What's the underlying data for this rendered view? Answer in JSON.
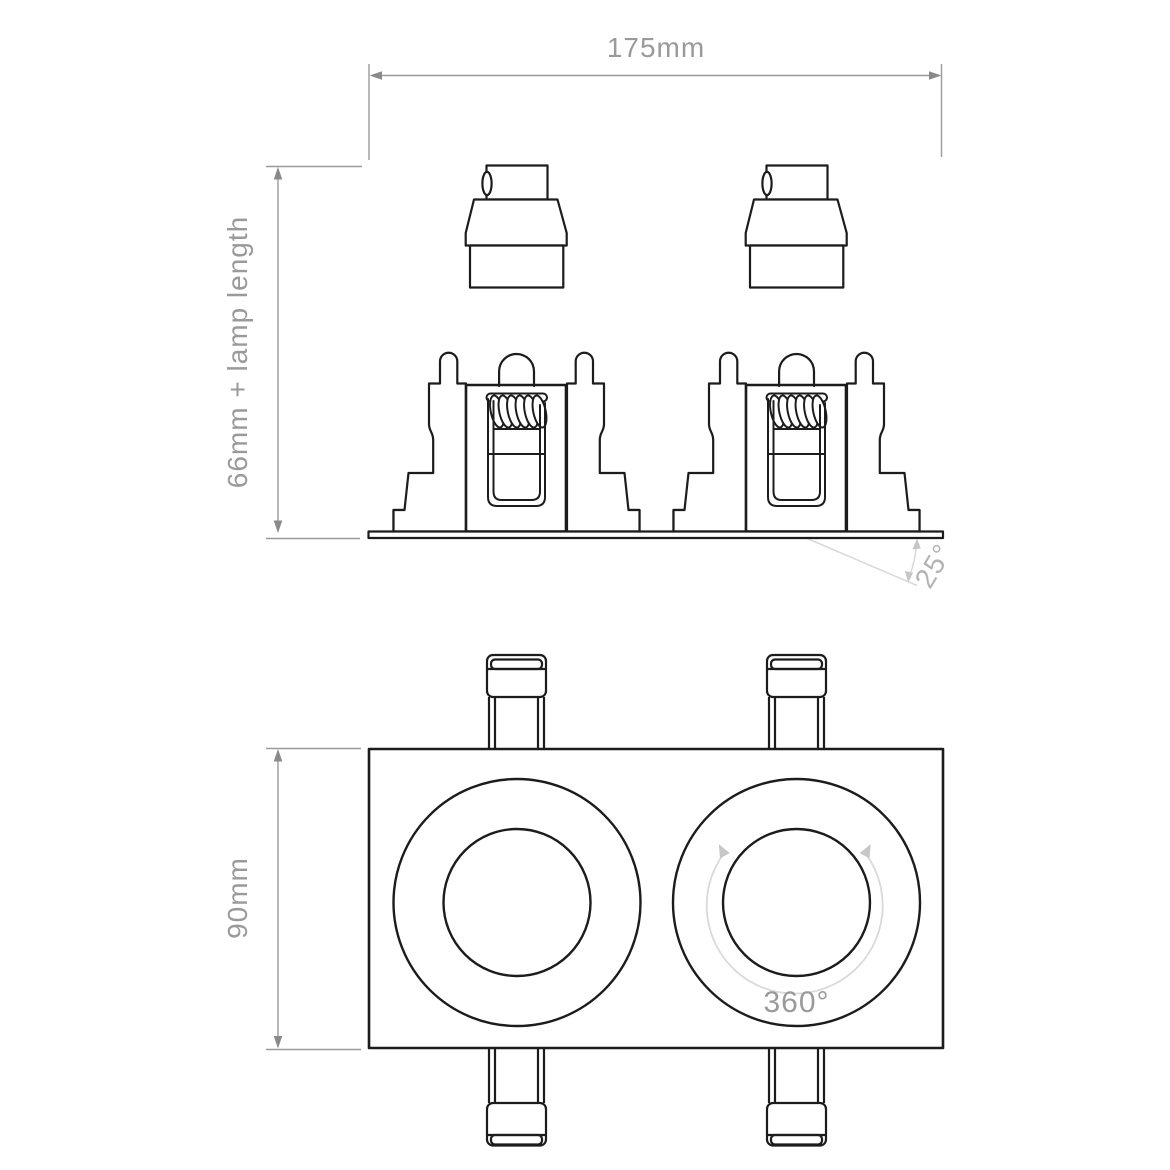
{
  "drawing": {
    "top_dimension": "175mm",
    "side_dimension": "66mm + lamp length",
    "tilt_angle": "25°",
    "plan_height_dimension": "90mm",
    "rotation_angle": "360°"
  },
  "colors": {
    "ink": "#1c1c1c",
    "white": "#ffffff",
    "dim_line": "#9a9a9a",
    "dim_arrow": "#8a8a8a",
    "dim_text": "#9a9a9a",
    "light_line": "#d9d9d9",
    "light_arrow": "#c6c6c6",
    "tilt_text": "#b3b3b3"
  }
}
